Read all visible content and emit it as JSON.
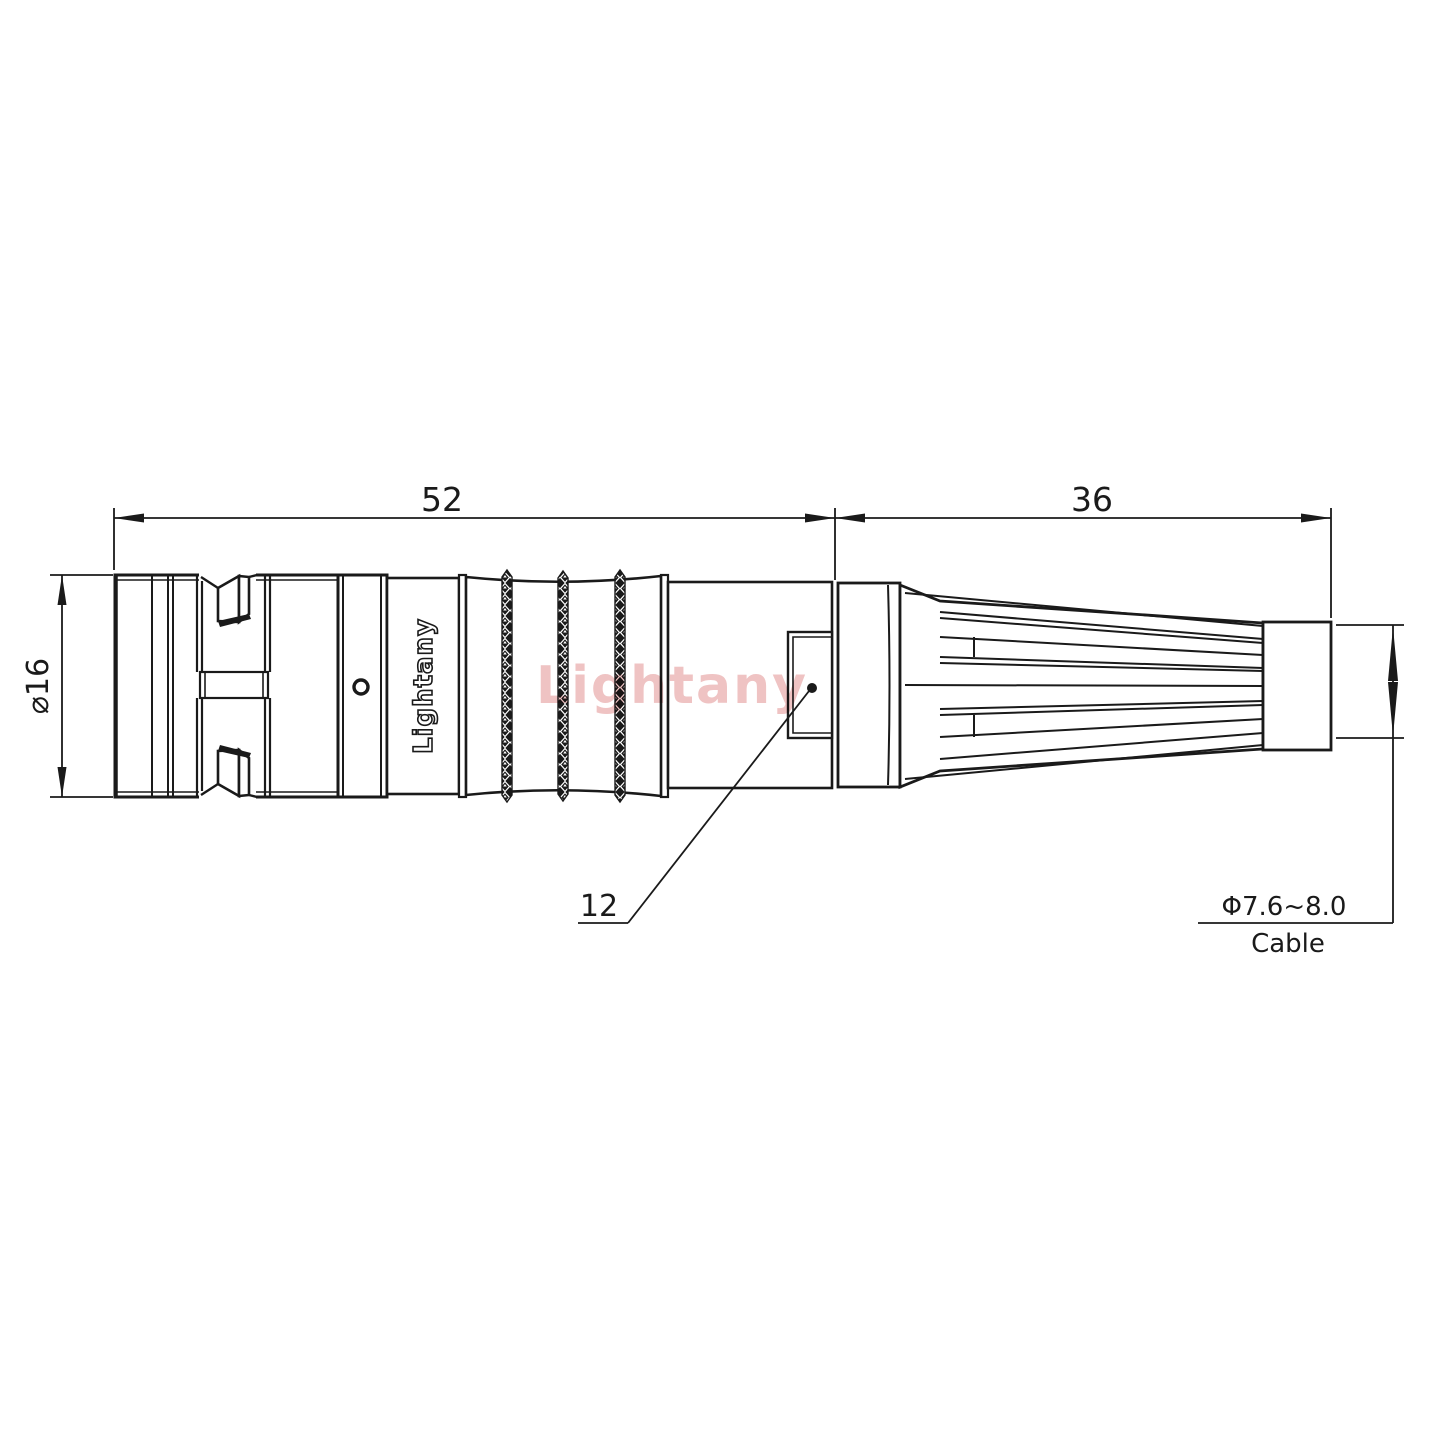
{
  "dims": {
    "body_length": "52",
    "boot_length": "36",
    "diameter": "⌀16",
    "ref": "12",
    "cable_range": "Φ7.6~8.0",
    "cable_label": "Cable"
  },
  "branding": {
    "marking": "Lightany",
    "watermark": "Lightany"
  },
  "colors": {
    "line": "#1a1a1a",
    "watermark_pink": "#efc3c3",
    "background": "#ffffff"
  }
}
